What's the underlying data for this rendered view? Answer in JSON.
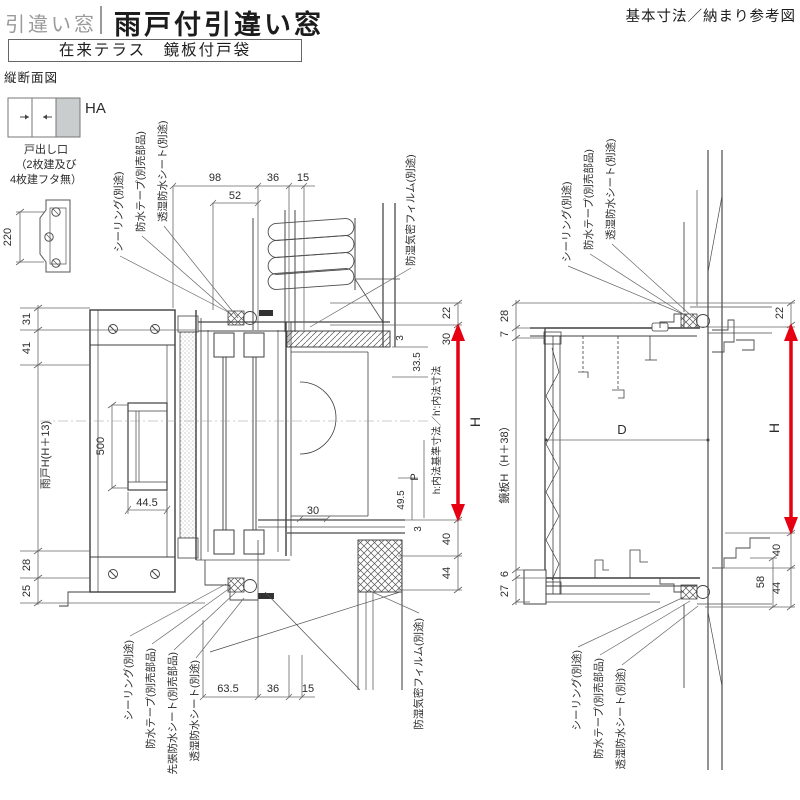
{
  "header": {
    "category": "引違い窓",
    "title": "雨戸付引違い窓",
    "corner_note": "基本寸法／納まり参考図",
    "subtitle": "在来テラス　鏡板付戸袋",
    "section_label": "縦断面図"
  },
  "legend": {
    "type_label": "HA",
    "note_line1": "戸出し口",
    "note_line2": "（2枚建及び",
    "note_line3": "4枚建フタ無）",
    "part_dim": "220"
  },
  "materials": {
    "sealing": "シーリング(別途)",
    "tape": "防水テープ(別売部品)",
    "pre_sheet": "先張防水シート(別売部品)",
    "sheet": "透湿防水シート(別途)",
    "film": "防湿気密フィルム(別途)"
  },
  "left": {
    "top_dims": {
      "w98": "98",
      "w52": "52",
      "w36": "36",
      "w15": "15"
    },
    "left_dims": {
      "h31": "31",
      "h41": "41",
      "shutter": "雨戸H(H＋13)",
      "h500": "500",
      "w44_5": "44.5",
      "h28": "28",
      "h25": "25"
    },
    "inner_dims": {
      "g3a": "3",
      "g33_5": "33.5",
      "note": "h:内法基準寸法／h′:内法寸法",
      "p": "P",
      "g49_5": "49.5",
      "g3b": "3",
      "g30": "30"
    },
    "right_dims": {
      "h22": "22",
      "h30": "30",
      "h_label": "H",
      "h40": "40",
      "h44": "44"
    },
    "bottom_dims": {
      "w63_5": "63.5",
      "w36": "36",
      "w15": "15"
    }
  },
  "right": {
    "left_dims": {
      "h28": "28",
      "h7": "7",
      "panel": "鏡板H（H＋38）",
      "h6": "6",
      "h27": "27"
    },
    "d_label": "D",
    "right_dims": {
      "h22": "22",
      "h_label": "H",
      "h40": "40",
      "h58": "58",
      "h44": "44"
    }
  },
  "colors": {
    "accent_red": "#e60012",
    "line_dark": "#3c3c3c",
    "title_gray": "#9a9a9a"
  }
}
